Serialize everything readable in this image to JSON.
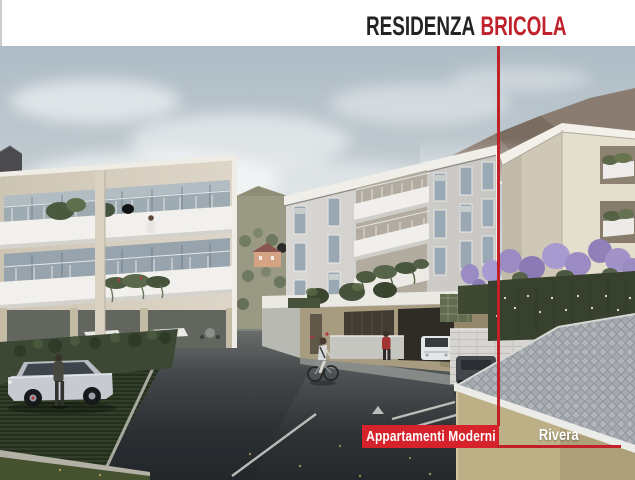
{
  "header": {
    "title_primary": "RESIDENZA",
    "title_accent": "BRICOLA"
  },
  "overlay": {
    "primary_label": "Appartamenti Moderni",
    "location_label": "Rivera"
  },
  "colors": {
    "accent_red": "#c02028",
    "label_red": "#d6232b",
    "title_red": "#bf222b",
    "title_dark": "#232325",
    "header_bg": "#ffffff"
  }
}
